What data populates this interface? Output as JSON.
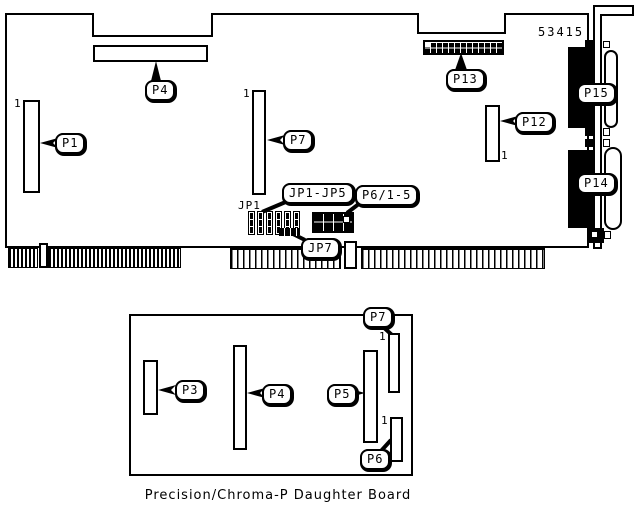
{
  "diagram": {
    "main_board": {
      "part_number": "53415",
      "jp1_label": "JP1",
      "pin1": "1",
      "callouts": {
        "p1": "P1",
        "p4": "P4",
        "p7": "P7",
        "p12": "P12",
        "p13": "P13",
        "p14": "P14",
        "p15": "P15",
        "jp1_jp5": "JP1-JP5",
        "p6_1_5": "P6/1-5",
        "jp7": "JP7"
      }
    },
    "daughter_board": {
      "caption": "Precision/Chroma-P Daughter Board",
      "pin1": "1",
      "callouts": {
        "p3": "P3",
        "p4": "P4",
        "p5": "P5",
        "p6": "P6",
        "p7": "P7"
      }
    }
  }
}
